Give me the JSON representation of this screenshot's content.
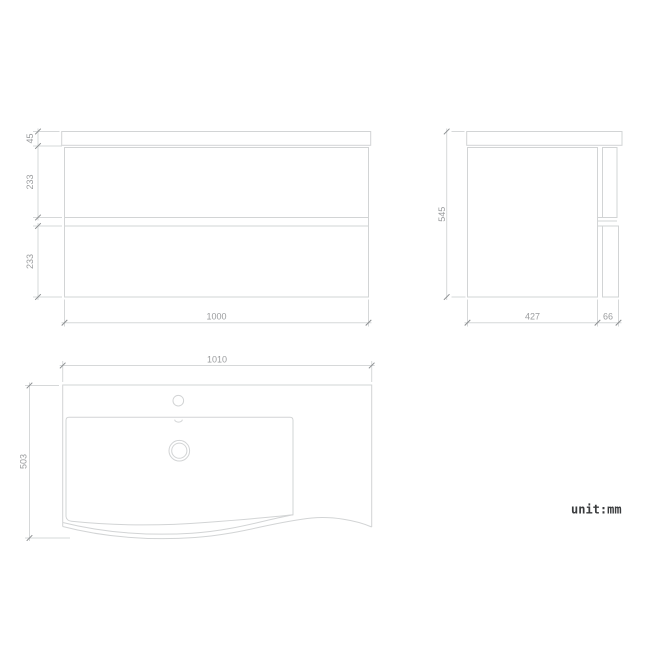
{
  "unit_label": "unit:mm",
  "front_view": {
    "dim_top": "45",
    "dim_upper_drawer": "233",
    "dim_lower_drawer": "233",
    "dim_width": "1000"
  },
  "side_view": {
    "dim_height": "545",
    "dim_depth": "427",
    "dim_drawer_front": "66"
  },
  "top_view": {
    "dim_width": "1010",
    "dim_depth": "503"
  },
  "colors": {
    "background": "#ffffff",
    "object_line": "#d2d4d5",
    "dim_line": "#d6d8d9",
    "tick": "#8c8f91",
    "dim_text": "#9a9c9e",
    "unit_text": "#3a3c3e"
  }
}
